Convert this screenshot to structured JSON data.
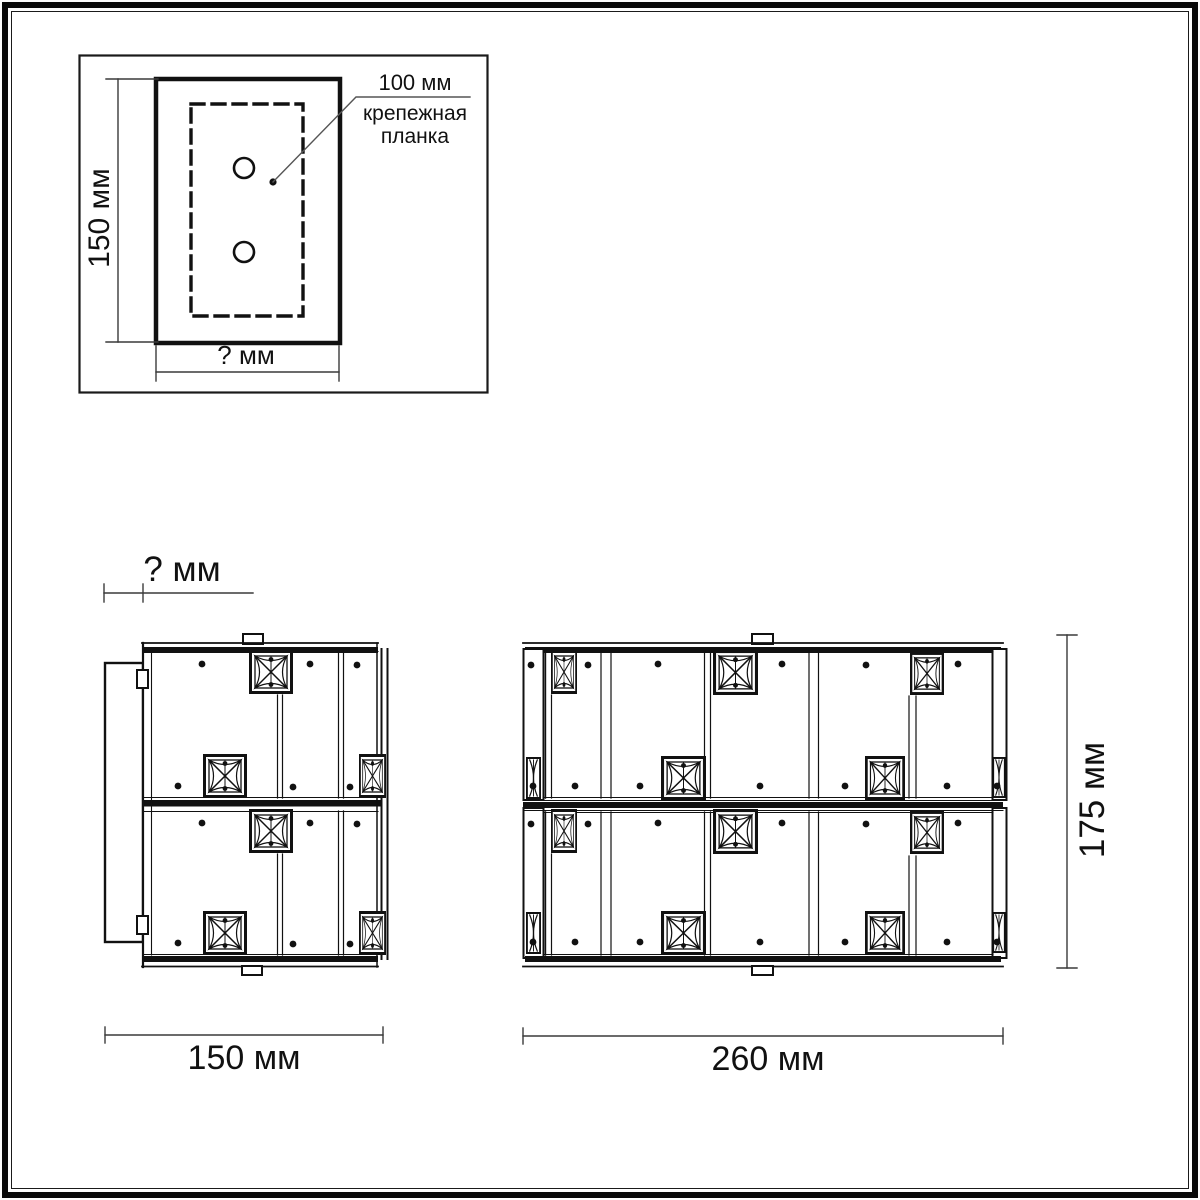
{
  "inset": {
    "height_label": "150 мм",
    "width_label": "? мм",
    "hole_spacing_label": "100 мм",
    "bracket_label": "крепежная\nпланка"
  },
  "side_view": {
    "depth_label": "? мм",
    "width_label": "150 мм"
  },
  "front_view": {
    "width_label": "260 мм",
    "height_label": "175 мм"
  },
  "colors": {
    "ink": "#111111",
    "dim_line": "#3a3a3a",
    "background": "#ffffff"
  }
}
